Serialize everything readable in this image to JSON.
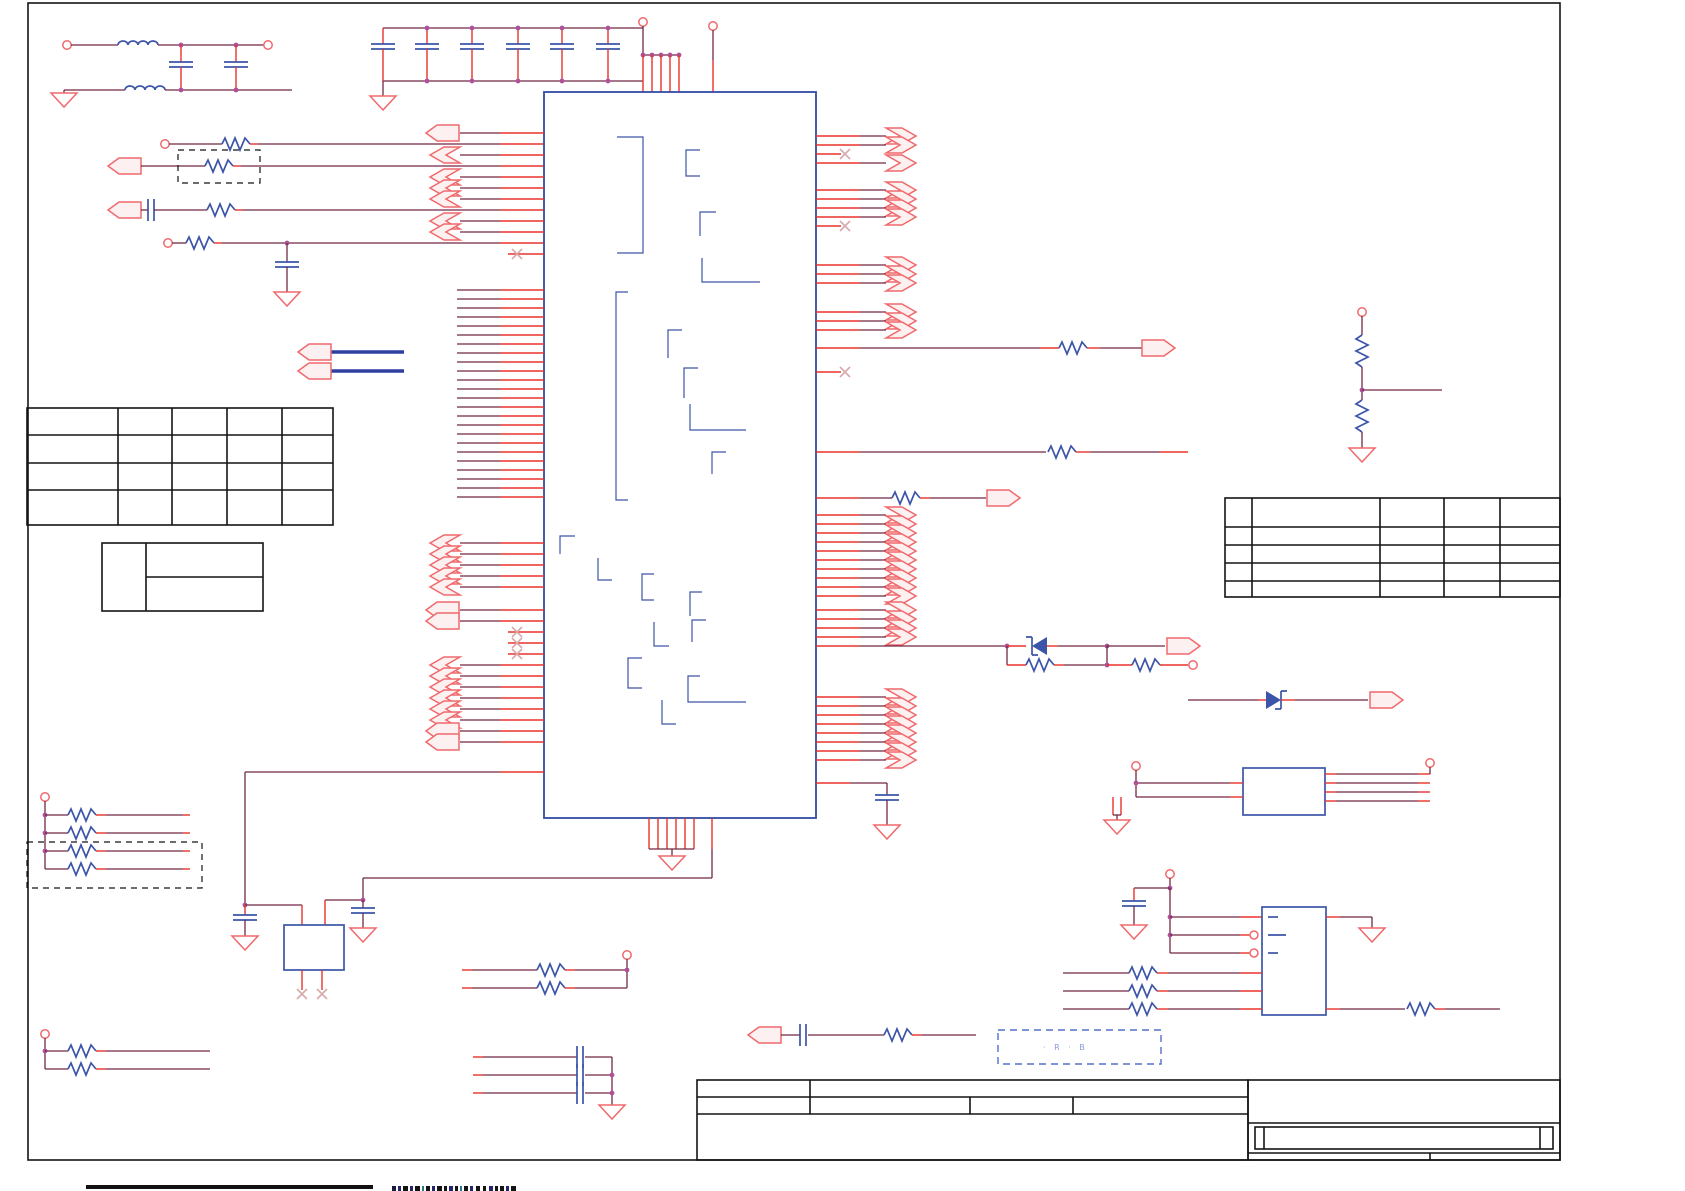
{
  "sheet": {
    "width": 1685,
    "height": 1191,
    "background": "#ffffff"
  },
  "colors": {
    "wire": "#702844",
    "pin_stub": "#e8332a",
    "port_outline": "#f0696c",
    "component_blue": "#3d55a8",
    "bus_blue": "#2e3f9f",
    "junction_dot": "#b0509c",
    "frame_black": "#141414",
    "note_dashed": "#5470cc",
    "note_text": "#8a9bd8",
    "no_connect_mark": "#d9a9ab"
  },
  "note_box": {
    "label": "· R ·  B"
  },
  "tables": {
    "left_main": {
      "rows": 4,
      "cols": 5,
      "cells": ""
    },
    "left_small": {
      "rows": 2,
      "cols": 2,
      "cells": ""
    },
    "right_pin": {
      "rows": 5,
      "cols": 5,
      "cells": ""
    },
    "title_block": {
      "cells": ""
    }
  },
  "schematic": {
    "geom": {
      "ic": {
        "x1": 544,
        "y1": 92,
        "x2": 816,
        "y2": 818
      },
      "left": {
        "stub_x": 500,
        "wire_x": 460,
        "chev_x": 430,
        "arrow_x": 426,
        "x_mark": 517,
        "x_line": 508,
        "bus_x": 457
      },
      "right": {
        "stub_x": 860,
        "wire_end": 886,
        "chev_x": 916,
        "x_mark": 845,
        "x_line": 841
      }
    },
    "pin_groups": [
      {
        "name": "left-ports-a-arrow",
        "side": "left",
        "port": "arrow",
        "ys": [
          133
        ]
      },
      {
        "name": "left-ports-a-chev",
        "side": "left",
        "port": "chev",
        "ys": [
          155,
          177,
          188,
          199,
          221,
          232
        ]
      },
      {
        "name": "left-ports-a-nc",
        "side": "left",
        "port": "x",
        "ys": [
          254
        ]
      },
      {
        "name": "left-bus-stubs",
        "side": "left",
        "port": "stub",
        "ys": [
          290,
          299,
          308,
          317,
          326,
          335,
          344,
          353,
          362,
          371,
          380,
          389,
          398,
          407,
          416,
          425,
          434,
          443,
          452,
          461,
          470,
          479,
          488,
          497
        ]
      },
      {
        "name": "left-ports-b-chev",
        "side": "left",
        "port": "chev",
        "ys": [
          543,
          554,
          565,
          576,
          587
        ]
      },
      {
        "name": "left-ports-c-arrow",
        "side": "left",
        "port": "arrow",
        "ys": [
          610,
          621
        ]
      },
      {
        "name": "left-ports-c-nc",
        "side": "left",
        "port": "x",
        "ys": [
          632,
          643,
          654
        ]
      },
      {
        "name": "left-ports-d-chev",
        "side": "left",
        "port": "chev",
        "ys": [
          665,
          676,
          687,
          698,
          709,
          720
        ]
      },
      {
        "name": "left-ports-d-arrow",
        "side": "left",
        "port": "arrow",
        "ys": [
          731,
          742
        ]
      },
      {
        "name": "right-ports-a-chev",
        "side": "right",
        "port": "chev",
        "ys": [
          136,
          145,
          163
        ]
      },
      {
        "name": "right-ports-a-nc",
        "side": "right",
        "port": "x",
        "ys": [
          154
        ]
      },
      {
        "name": "right-ports-b-chev",
        "side": "right",
        "port": "chev",
        "ys": [
          190,
          199,
          208,
          217
        ]
      },
      {
        "name": "right-ports-b-nc",
        "side": "right",
        "port": "x",
        "ys": [
          226
        ]
      },
      {
        "name": "right-ports-c-chev",
        "side": "right",
        "port": "chev",
        "ys": [
          265,
          274,
          283
        ]
      },
      {
        "name": "right-ports-d-chev",
        "side": "right",
        "port": "chev",
        "ys": [
          312,
          321,
          330
        ]
      },
      {
        "name": "right-ports-d-nc",
        "side": "right",
        "port": "x",
        "ys": [
          372
        ]
      },
      {
        "name": "right-bus-chev",
        "side": "right",
        "port": "chev",
        "ys": [
          515,
          524,
          533,
          542,
          551,
          560,
          569,
          578,
          587,
          596
        ]
      },
      {
        "name": "right-ports-e-chev",
        "side": "right",
        "port": "chev",
        "ys": [
          610,
          619,
          628,
          637
        ]
      },
      {
        "name": "right-ports-f-chev",
        "side": "right",
        "port": "chev",
        "ys": [
          697,
          706,
          715,
          724,
          733,
          742,
          751,
          760
        ]
      }
    ]
  }
}
